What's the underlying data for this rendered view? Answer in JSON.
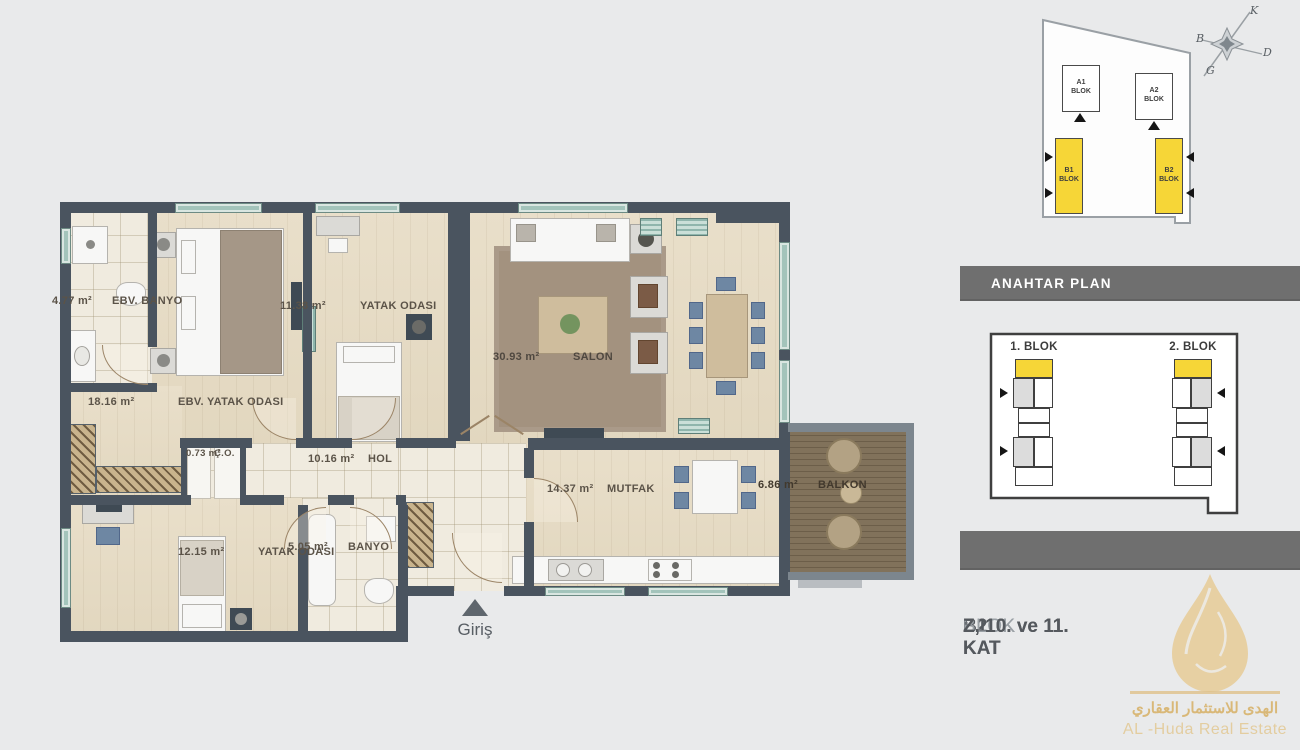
{
  "floor_plan": {
    "entrance": {
      "label": "Giriş"
    },
    "rooms": {
      "ebv_banyo": {
        "name": "EBV. BANYO",
        "area": "4.77 m²"
      },
      "ebv_yatak": {
        "name": "EBV. YATAK ODASI",
        "area": "18.16 m²"
      },
      "yatak1": {
        "name": "YATAK ODASI",
        "area": "11.38 m²"
      },
      "salon": {
        "name": "SALON",
        "area": "30.93 m²"
      },
      "co": {
        "name": "Ç.O.",
        "area": "0.73 m²"
      },
      "hol": {
        "name": "HOL",
        "area": "10.16 m²"
      },
      "yatak2": {
        "name": "YATAK ODASI",
        "area": "12.15 m²"
      },
      "banyo": {
        "name": "BANYO",
        "area": "5.05 m²"
      },
      "mutfak": {
        "name": "MUTFAK",
        "area": "14.37 m²"
      },
      "balkon": {
        "name": "BALKON",
        "area": "6.86 m²"
      }
    }
  },
  "site_plan": {
    "blocks": {
      "a1": "A1\nBLOK",
      "a2": "A2\nBLOK",
      "b1": "B1\nBLOK",
      "b2": "B2\nBLOK"
    },
    "compass": {
      "north": "K",
      "west": "B",
      "east": "D",
      "south": "G"
    }
  },
  "key_plan": {
    "header": "ANAHTAR PLAN",
    "block1_label": "1. BLOK",
    "block2_label": "2. BLOK",
    "highlight_color": "#f6d637"
  },
  "floor_info": {
    "rows": [
      {
        "block": "B1",
        "type": "BLOK",
        "sep": ":",
        "floors": "Z, 10. ve 11. KAT"
      },
      {
        "block": "B2",
        "type": "BLOK",
        "sep": ":",
        "floors": "Z, 10. ve 11. KAT"
      }
    ]
  },
  "logo": {
    "arabic": "الهدى للاستثمار العقاري",
    "english": "AL -Huda Real Estate"
  },
  "colors": {
    "wall": "#4a545f",
    "highlight_yellow": "#f6d637",
    "panel_gray": "#6f6f6f",
    "gold": "#d9b878"
  }
}
